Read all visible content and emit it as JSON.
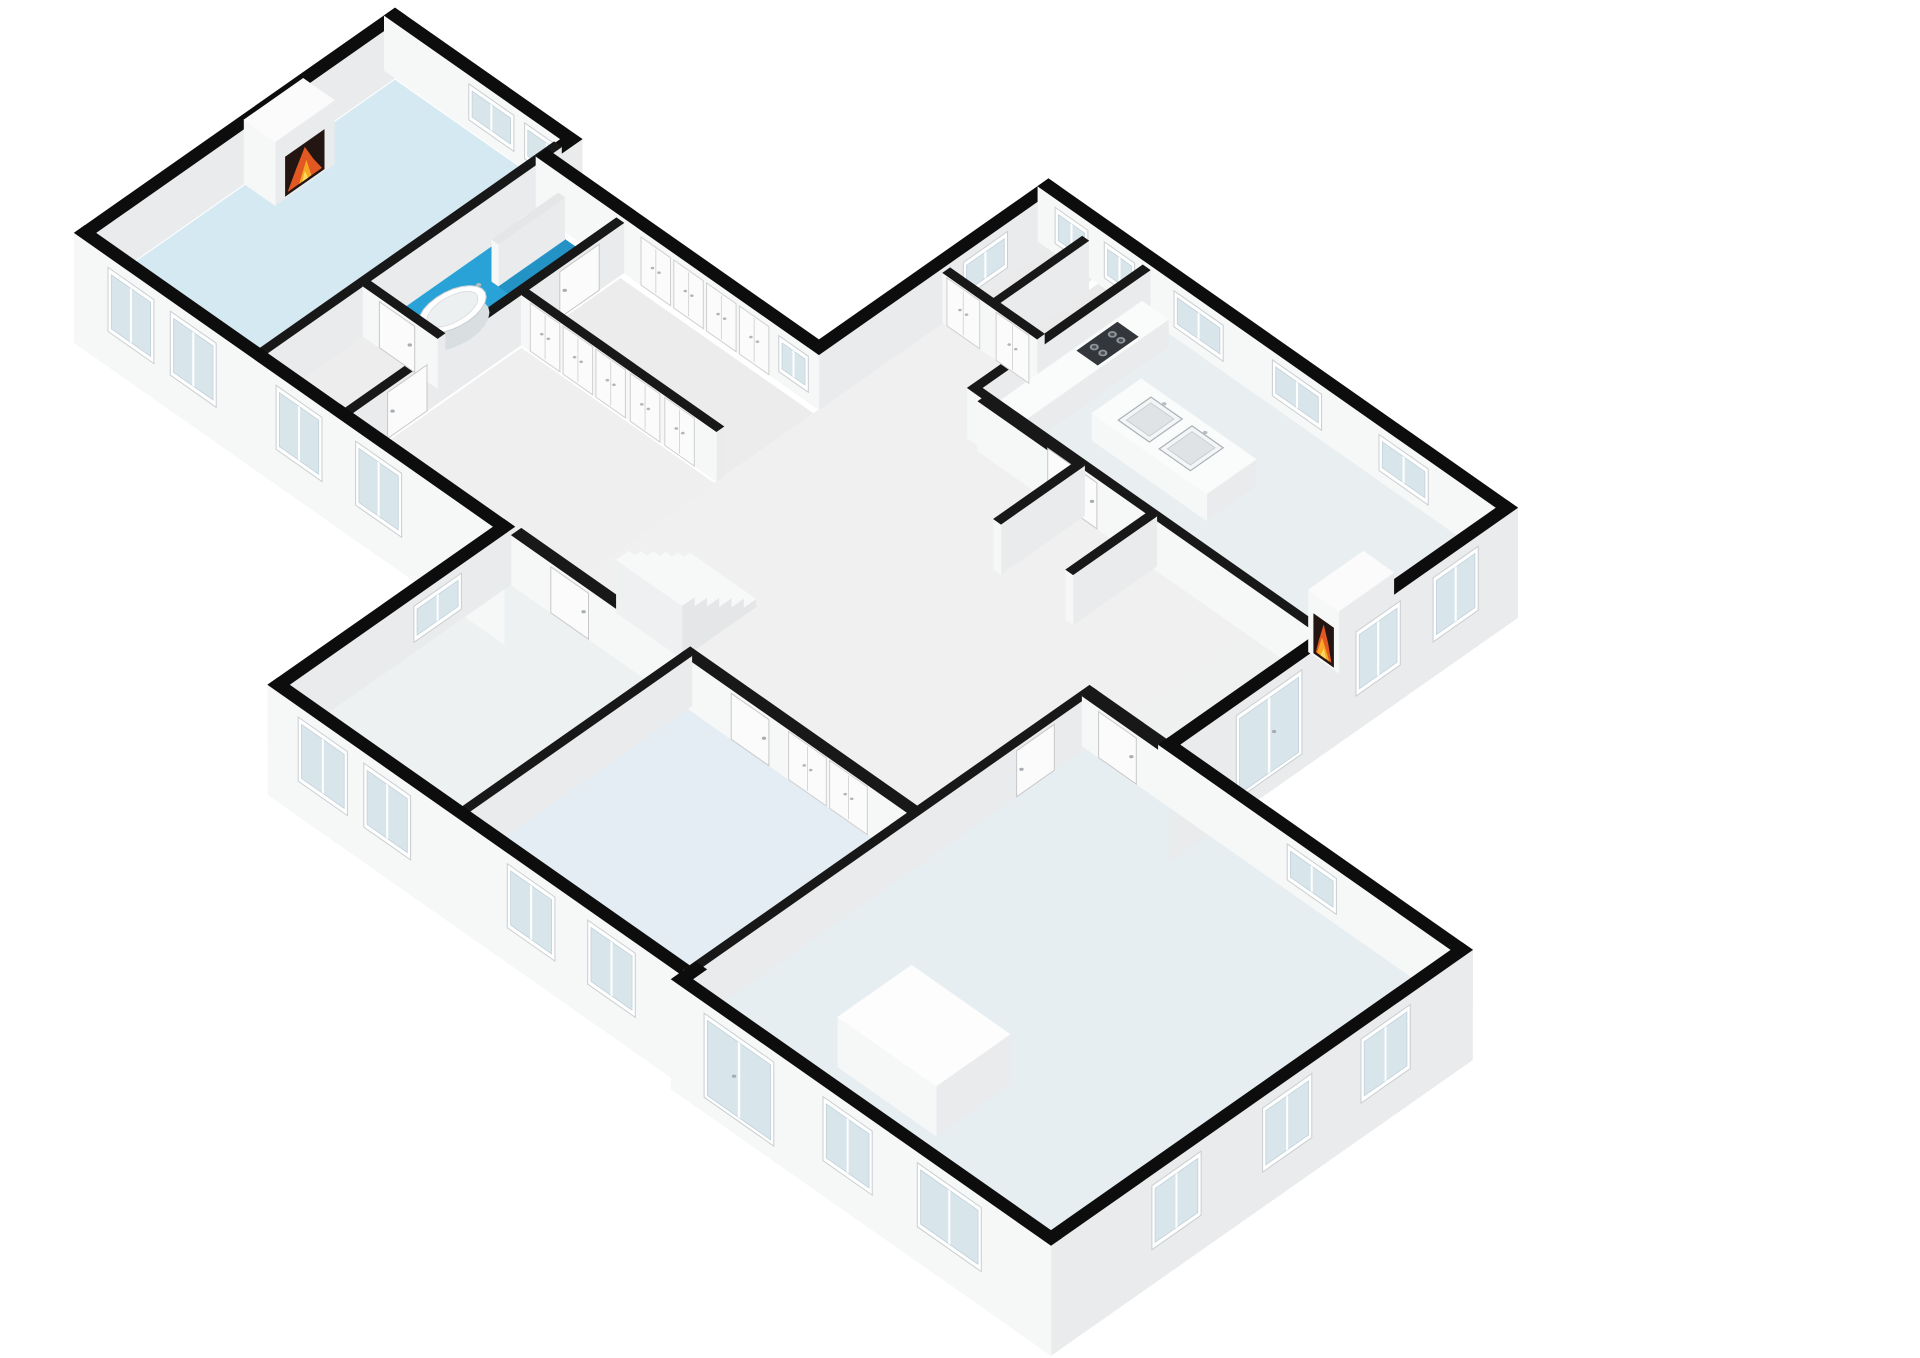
{
  "app": {
    "type": "floorplan-3d-axonometric",
    "description": "3D isometric rendering of a single-storey house floor plan on a white background; no text labels visible",
    "background": "#ffffff"
  },
  "palette": {
    "exterior_wall_top": "#0d0d0d",
    "interior_wall_top": "#181818",
    "wall_face_se": "#e9ebec",
    "wall_face_sw": "#f6f7f7",
    "glass": "#d8e6ec",
    "frame": "#ffffff",
    "door": "#fbfbfb",
    "bathroom_floor": "#29a2d8",
    "shower_floor": "#2393c6",
    "living_floor": "#d5e9f3",
    "bedroom_floor": "#e3edf3",
    "fire_orange": "#e25822",
    "fire_yellow": "#f9a825",
    "stove": "#33373b",
    "accent_red_item": "#e06a45"
  },
  "projection": {
    "ox": 395,
    "oy": 78,
    "kx": 0.82,
    "ky": 0.575,
    "wall_height_exterior": 55,
    "wall_height_interior": 50,
    "plinth_drop": -55
  },
  "floors": [
    {
      "id": "living-room",
      "r": [
        2,
        2,
        196,
        365
      ],
      "c": "#d5e9f3"
    },
    {
      "id": "bathroom",
      "r": [
        205,
        37,
        296,
        235
      ],
      "c": "#29a2d8"
    },
    {
      "id": "shower",
      "r": [
        240,
        37,
        296,
        118
      ],
      "c": "#2393c6"
    },
    {
      "id": "bath-lobby",
      "r": [
        205,
        244,
        296,
        358
      ],
      "c": "#ededed"
    },
    {
      "id": "wardrobe-corridor",
      "r": [
        312,
        37,
        547,
        146
      ],
      "c": "#ececec"
    },
    {
      "id": "entry-hall",
      "r": [
        312,
        158,
        547,
        358
      ],
      "c": "#efefef"
    },
    {
      "id": "central-hall-1",
      "r": [
        547,
        -121,
        671,
        358
      ],
      "c": "#f0f0f0"
    },
    {
      "id": "central-hall-2",
      "r": [
        671,
        -36,
        1005,
        148
      ],
      "c": "#f0f0f0"
    },
    {
      "id": "central-hall-3",
      "r": [
        671,
        148,
        995,
        365
      ],
      "c": "#f0f0f0"
    },
    {
      "id": "central-hall-4",
      "r": [
        1005,
        -36,
        1093,
        148
      ],
      "c": "#eff1f1"
    },
    {
      "id": "storage-1",
      "r": [
        547,
        -250,
        600,
        -130
      ],
      "c": "#eaeaea"
    },
    {
      "id": "storage-2",
      "r": [
        608,
        -250,
        662,
        -130
      ],
      "c": "#eaeaea"
    },
    {
      "id": "kitchen",
      "r": [
        671,
        -250,
        1093,
        -36
      ],
      "c": "#e9eff1"
    },
    {
      "id": "bedroom-middle",
      "r": [
        727,
        370,
        995,
        633
      ],
      "c": "#e3edf3"
    },
    {
      "id": "room-bottom-left",
      "r": [
        511,
        370,
        718,
        633
      ],
      "c": "#eef1f2"
    },
    {
      "id": "bedroom-main",
      "r": [
        1004,
        162,
        1443,
        643
      ],
      "c": "#e6eef2"
    }
  ],
  "walls": [
    {
      "id": "ext-wing-nw",
      "r": [
        -13,
        -13,
        0,
        378
      ],
      "ext": true
    },
    {
      "id": "ext-wing-ne",
      "r": [
        -13,
        -13,
        215,
        0
      ],
      "ext": true
    },
    {
      "id": "ext-notch",
      "r": [
        202,
        -13,
        215,
        30
      ],
      "ext": true
    },
    {
      "id": "ext-corridor-ne",
      "r": [
        202,
        17,
        547,
        30
      ],
      "ext": true
    },
    {
      "id": "ext-main-nw",
      "r": [
        534,
        -263,
        547,
        30
      ],
      "ext": true
    },
    {
      "id": "ext-main-ne",
      "r": [
        534,
        -263,
        1106,
        -250
      ],
      "ext": true
    },
    {
      "id": "ext-kitchen-se",
      "r": [
        1093,
        -263,
        1106,
        162
      ],
      "ext": true,
      "dropX": true
    },
    {
      "id": "ext-bedroom-main-ne",
      "r": [
        1093,
        149,
        1463,
        162
      ],
      "ext": true
    },
    {
      "id": "ext-bedroom-main-se",
      "r": [
        1450,
        149,
        1463,
        663
      ],
      "ext": true,
      "dropX": true,
      "dropY": true
    },
    {
      "id": "ext-bedroom-main-sw",
      "r": [
        1000,
        650,
        1463,
        663
      ],
      "ext": true,
      "dropY": true,
      "dropX": true
    },
    {
      "id": "ext-step-sw",
      "r": [
        1000,
        633,
        1013,
        663
      ],
      "ext": true,
      "dropY": true
    },
    {
      "id": "ext-bottom-sw",
      "r": [
        498,
        640,
        1013,
        653
      ],
      "ext": true,
      "dropY": true
    },
    {
      "id": "ext-bottom-left-w",
      "r": [
        498,
        365,
        511,
        653
      ],
      "ext": true
    },
    {
      "id": "ext-corrblock-sw",
      "r": [
        298,
        365,
        511,
        378
      ],
      "ext": true,
      "dropY": true
    },
    {
      "id": "ext-wing-sw",
      "r": [
        -13,
        365,
        311,
        378
      ],
      "ext": true,
      "dropY": true
    },
    {
      "id": "int-living-bath",
      "r": [
        196,
        2,
        205,
        365
      ]
    },
    {
      "id": "int-bath-lobby",
      "r": [
        205,
        235,
        296,
        244
      ]
    },
    {
      "id": "int-wing-corr",
      "r": [
        300,
        30,
        309,
        365
      ]
    },
    {
      "id": "int-corr-hall",
      "r": [
        309,
        146,
        547,
        155
      ]
    },
    {
      "id": "int-storage-s",
      "r": [
        547,
        -130,
        662,
        -121
      ]
    },
    {
      "id": "int-storage-div",
      "r": [
        600,
        -238,
        608,
        -130
      ]
    },
    {
      "id": "int-kitchen-nw",
      "r": [
        662,
        -250,
        671,
        -36
      ]
    },
    {
      "id": "int-kitchen-sw",
      "r": [
        671,
        -45,
        1093,
        -36
      ]
    },
    {
      "id": "int-bedmid-n",
      "r": [
        718,
        358,
        1005,
        370
      ]
    },
    {
      "id": "int-bedmain-n",
      "r": [
        1000,
        148,
        1098,
        162
      ]
    },
    {
      "id": "int-bedmain-w",
      "r": [
        995,
        148,
        1004,
        643
      ]
    },
    {
      "id": "int-bottomleft-e",
      "r": [
        718,
        365,
        727,
        645
      ]
    },
    {
      "id": "int-bottomleft-n",
      "r": [
        512,
        358,
        718,
        370
      ]
    },
    {
      "id": "int-shower-partition",
      "r": [
        236,
        37,
        244,
        118
      ],
      "h": 42,
      "top": "#e4e6e8"
    },
    {
      "id": "int-hall-stub-1",
      "r": [
        680,
        -40,
        800,
        -31
      ]
    },
    {
      "id": "int-hall-stub-2",
      "r": [
        792,
        -40,
        801,
        62
      ]
    },
    {
      "id": "int-hall-stub-3",
      "r": [
        880,
        -40,
        889,
        62
      ]
    }
  ],
  "openings": [
    {
      "type": "door",
      "id": "door-living",
      "axis": "x",
      "at": 309,
      "s": [
        60,
        108
      ]
    },
    {
      "type": "door",
      "id": "door-lobby",
      "axis": "x",
      "at": 309,
      "s": [
        270,
        318
      ]
    },
    {
      "type": "door",
      "id": "door-bathroom",
      "axis": "y",
      "at": 244,
      "s": [
        225,
        268
      ]
    },
    {
      "type": "door",
      "id": "door-room-bottom-left",
      "axis": "y",
      "at": 370,
      "s": [
        560,
        606
      ]
    },
    {
      "type": "door",
      "id": "door-bedroom-middle",
      "axis": "y",
      "at": 370,
      "s": [
        780,
        826
      ]
    },
    {
      "type": "door",
      "id": "door-bedroom-main-n",
      "axis": "y",
      "at": 162,
      "s": [
        1020,
        1066
      ]
    },
    {
      "type": "door",
      "id": "door-bedroom-main-w",
      "axis": "x",
      "at": 1004,
      "s": [
        200,
        246
      ]
    },
    {
      "type": "door",
      "id": "door-kitchen",
      "axis": "y",
      "at": -36,
      "s": [
        760,
        820
      ]
    },
    {
      "type": "closet",
      "id": "storage-door-1",
      "axis": "y",
      "at": -121,
      "s": [
        552,
        592
      ]
    },
    {
      "type": "closet",
      "id": "storage-door-2",
      "axis": "y",
      "at": -121,
      "s": [
        612,
        652
      ]
    },
    {
      "type": "closet",
      "id": "wardrobe-a1",
      "axis": "y",
      "at": 30,
      "s": [
        330,
        366
      ]
    },
    {
      "type": "closet",
      "id": "wardrobe-a2",
      "axis": "y",
      "at": 30,
      "s": [
        370,
        406
      ]
    },
    {
      "type": "closet",
      "id": "wardrobe-a3",
      "axis": "y",
      "at": 30,
      "s": [
        410,
        446
      ]
    },
    {
      "type": "closet",
      "id": "wardrobe-a4",
      "axis": "y",
      "at": 30,
      "s": [
        450,
        486
      ]
    },
    {
      "type": "closet",
      "id": "wardrobe-b1",
      "axis": "y",
      "at": 155,
      "s": [
        320,
        356
      ]
    },
    {
      "type": "closet",
      "id": "wardrobe-b2",
      "axis": "y",
      "at": 155,
      "s": [
        360,
        396
      ]
    },
    {
      "type": "closet",
      "id": "wardrobe-b3",
      "axis": "y",
      "at": 155,
      "s": [
        400,
        436
      ]
    },
    {
      "type": "closet",
      "id": "wardrobe-b4",
      "axis": "y",
      "at": 155,
      "s": [
        442,
        478
      ]
    },
    {
      "type": "closet",
      "id": "wardrobe-b5",
      "axis": "y",
      "at": 155,
      "s": [
        484,
        520
      ]
    },
    {
      "type": "closet",
      "id": "closet-bedmid-1",
      "axis": "y",
      "at": 370,
      "s": [
        850,
        896
      ]
    },
    {
      "type": "closet",
      "id": "closet-bedmid-2",
      "axis": "y",
      "at": 370,
      "s": [
        900,
        946
      ]
    },
    {
      "type": "window",
      "id": "win-living-ne-1",
      "axis": "y",
      "at": 0,
      "s": [
        90,
        145
      ],
      "z": [
        10,
        46
      ]
    },
    {
      "type": "window",
      "id": "win-living-ne-2",
      "axis": "y",
      "at": 0,
      "s": [
        158,
        212
      ],
      "z": [
        10,
        46
      ]
    },
    {
      "type": "window",
      "id": "win-corridor-ne",
      "axis": "y",
      "at": 30,
      "s": [
        498,
        534
      ],
      "z": [
        10,
        46
      ]
    },
    {
      "type": "window",
      "id": "win-storage-w",
      "axis": "x",
      "at": 547,
      "s": [
        -200,
        -146
      ],
      "z": [
        10,
        46
      ]
    },
    {
      "type": "window",
      "id": "win-ne-storage1",
      "axis": "y",
      "at": -250,
      "s": [
        555,
        595
      ],
      "z": [
        10,
        46
      ]
    },
    {
      "type": "window",
      "id": "win-ne-storage2",
      "axis": "y",
      "at": -250,
      "s": [
        615,
        652
      ],
      "z": [
        10,
        46
      ]
    },
    {
      "type": "window",
      "id": "win-kitchen-ne-1",
      "axis": "y",
      "at": -250,
      "s": [
        700,
        760
      ],
      "z": [
        10,
        46
      ]
    },
    {
      "type": "window",
      "id": "win-kitchen-ne-2",
      "axis": "y",
      "at": -250,
      "s": [
        820,
        880
      ],
      "z": [
        10,
        46
      ]
    },
    {
      "type": "window",
      "id": "win-kitchen-ne-3",
      "axis": "y",
      "at": -250,
      "s": [
        950,
        1010
      ],
      "z": [
        10,
        46
      ]
    },
    {
      "type": "window",
      "id": "win-kitchen-se-1",
      "axis": "x",
      "at": 1106,
      "s": [
        -215,
        -160
      ],
      "z": [
        -20,
        44
      ]
    },
    {
      "type": "window",
      "id": "win-kitchen-se-2",
      "axis": "x",
      "at": 1106,
      "s": [
        -120,
        -66
      ],
      "z": [
        -20,
        44
      ]
    },
    {
      "type": "glassdoor",
      "id": "glassdoor-kitchen-se",
      "axis": "x",
      "at": 1106,
      "s": [
        0,
        80
      ],
      "z": [
        -40,
        44
      ]
    },
    {
      "type": "window",
      "id": "win-bedmain-ne",
      "axis": "y",
      "at": 162,
      "s": [
        1250,
        1310
      ],
      "z": [
        10,
        46
      ]
    },
    {
      "type": "window",
      "id": "win-bedmain-se-1",
      "axis": "x",
      "at": 1463,
      "s": [
        225,
        285
      ],
      "z": [
        -20,
        44
      ]
    },
    {
      "type": "window",
      "id": "win-bedmain-se-2",
      "axis": "x",
      "at": 1463,
      "s": [
        345,
        405
      ],
      "z": [
        -20,
        44
      ]
    },
    {
      "type": "window",
      "id": "win-bedmain-se-3",
      "axis": "x",
      "at": 1463,
      "s": [
        480,
        540
      ],
      "z": [
        -20,
        44
      ]
    },
    {
      "type": "glassdoor",
      "id": "frenchdoor-bedmain-sw",
      "axis": "y",
      "at": 663,
      "s": [
        1040,
        1125
      ],
      "z": [
        -40,
        44
      ]
    },
    {
      "type": "window",
      "id": "win-bedmain-sw-1",
      "axis": "y",
      "at": 663,
      "s": [
        1185,
        1245
      ],
      "z": [
        -20,
        44
      ]
    },
    {
      "type": "window",
      "id": "win-bedmain-sw-2",
      "axis": "y",
      "at": 663,
      "s": [
        1300,
        1378
      ],
      "z": [
        -20,
        44
      ]
    },
    {
      "type": "window",
      "id": "win-bottomleft-sw-1",
      "axis": "y",
      "at": 653,
      "s": [
        535,
        595
      ],
      "z": [
        -20,
        44
      ]
    },
    {
      "type": "window",
      "id": "win-bottomleft-sw-2",
      "axis": "y",
      "at": 653,
      "s": [
        615,
        672
      ],
      "z": [
        -20,
        44
      ]
    },
    {
      "type": "window",
      "id": "win-bedmid-sw-1",
      "axis": "y",
      "at": 653,
      "s": [
        790,
        848
      ],
      "z": [
        -20,
        44
      ]
    },
    {
      "type": "window",
      "id": "win-bedmid-sw-2",
      "axis": "y",
      "at": 653,
      "s": [
        888,
        946
      ],
      "z": [
        -20,
        44
      ]
    },
    {
      "type": "window",
      "id": "win-bottomleft-w",
      "axis": "x",
      "at": 511,
      "s": [
        430,
        488
      ],
      "z": [
        10,
        46
      ]
    },
    {
      "type": "window",
      "id": "win-entry-sw",
      "axis": "y",
      "at": 378,
      "s": [
        330,
        386
      ],
      "z": [
        -20,
        44
      ]
    },
    {
      "type": "window",
      "id": "win-living-sw-1",
      "axis": "y",
      "at": 378,
      "s": [
        28,
        84
      ],
      "z": [
        -20,
        44
      ]
    },
    {
      "type": "window",
      "id": "win-living-sw-2",
      "axis": "y",
      "at": 378,
      "s": [
        104,
        160
      ],
      "z": [
        -20,
        44
      ]
    },
    {
      "type": "window",
      "id": "win-bath-sw",
      "axis": "y",
      "at": 378,
      "s": [
        233,
        289
      ],
      "z": [
        -20,
        44
      ]
    }
  ],
  "fixtures": [
    {
      "type": "fireplace",
      "id": "fireplace-living",
      "r": [
        0,
        112,
        38,
        184
      ],
      "h": 64,
      "fire": {
        "axis": "x",
        "at": 38,
        "s": [
          124,
          172
        ]
      }
    },
    {
      "type": "fireplace",
      "id": "fireplace-kitchen",
      "r": [
        1056,
        -125,
        1093,
        -58
      ],
      "h": 62,
      "fire": {
        "axis": "y",
        "at": -58,
        "s": [
          1062,
          1087
        ]
      }
    },
    {
      "type": "box",
      "id": "kitchen-counter",
      "r": [
        673,
        -238,
        705,
        -60
      ],
      "h": 27,
      "top": "#fafbfb"
    },
    {
      "type": "stove",
      "id": "stove-4-burners",
      "r": [
        676,
        -205,
        702,
        -155
      ],
      "z": 27
    },
    {
      "type": "box",
      "id": "kitchen-island",
      "r": [
        740,
        -170,
        880,
        -110
      ],
      "h": 27,
      "top": "#fafbfb"
    },
    {
      "type": "sink",
      "id": "island-sink-1",
      "r": [
        762,
        -160,
        800,
        -120
      ],
      "z": 27
    },
    {
      "type": "sink",
      "id": "island-sink-2",
      "r": [
        812,
        -160,
        850,
        -120
      ],
      "z": 27
    },
    {
      "type": "box",
      "id": "built-in-closet",
      "r": [
        1130,
        500,
        1250,
        590
      ],
      "h": 50,
      "top": "#fdfdfd"
    },
    {
      "type": "tub",
      "id": "bathtub",
      "c": [
        250,
        180
      ],
      "a": 20,
      "b": 36
    },
    {
      "type": "toilet",
      "id": "toilet",
      "c": [
        222,
        58
      ]
    },
    {
      "type": "steps",
      "id": "staircase",
      "x": [
        600,
        680
      ],
      "yStart": 330,
      "n": 6,
      "depth": 15
    },
    {
      "type": "box",
      "id": "red-item",
      "r": [
        592,
        300,
        604,
        314
      ],
      "h": 14,
      "top": "#e06a45",
      "fx": "#b34227",
      "fy": "#cc5535"
    }
  ],
  "legend": {
    "rooms": [
      "living room with fireplace",
      "bathroom with freestanding tub and shower",
      "bath lobby",
      "wardrobe corridor",
      "entry hall with staircase",
      "central hall",
      "storage room 1",
      "storage room 2",
      "kitchen with island",
      "middle bedroom",
      "bottom-left room",
      "main bedroom with built-in closet"
    ],
    "fixtures": [
      "2 fireplaces with burning fire",
      "freestanding bathtub",
      "shower with partition",
      "toilet",
      "kitchen island with 2 sinks",
      "cooktop with 4 burners",
      "staircase of 6 treads",
      "rows of wardrobe doors",
      "built-in closet block",
      "small red object near stairs"
    ]
  }
}
